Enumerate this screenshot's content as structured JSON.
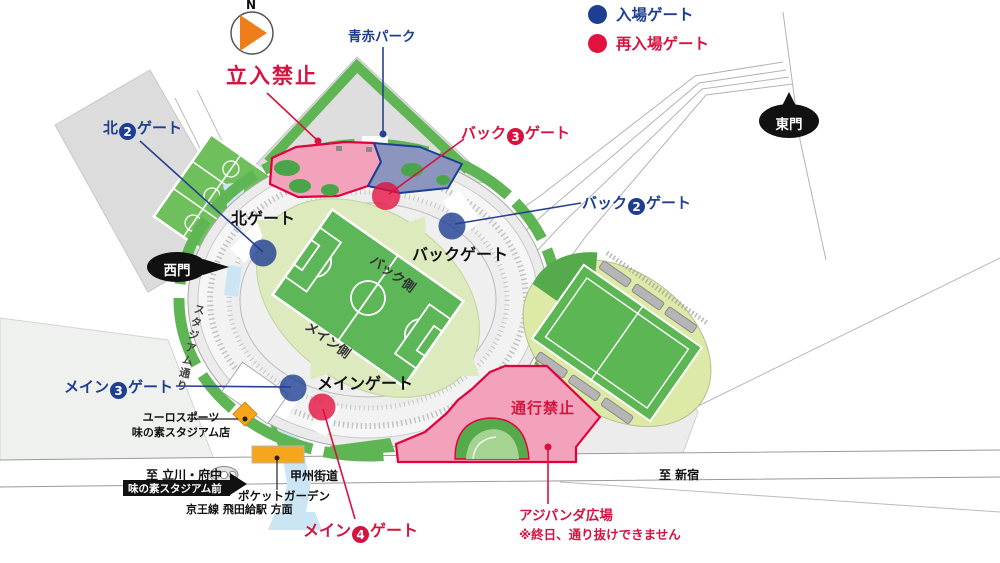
{
  "legend": {
    "items": [
      {
        "label": "入場ゲート",
        "color": "#1e3e92",
        "type": "entry"
      },
      {
        "label": "再入場ゲート",
        "color": "#e2123f",
        "type": "reentry"
      }
    ]
  },
  "compass": {
    "north_label": "N"
  },
  "zones": {
    "aoaka_park": {
      "label": "青赤パーク"
    },
    "no_entry": {
      "label": "立入禁止"
    },
    "no_passage": {
      "label": "通行禁止"
    },
    "ajipanda_plaza": {
      "label": "アジパンダ広場",
      "note": "※終日、通り抜けできません"
    }
  },
  "gates": {
    "north2": {
      "prefix": "北",
      "number": "2",
      "suffix": "ゲート",
      "type": "entry"
    },
    "back3": {
      "prefix": "バック",
      "number": "3",
      "suffix": "ゲート",
      "type": "reentry"
    },
    "back2": {
      "prefix": "バック",
      "number": "2",
      "suffix": "ゲート",
      "type": "entry"
    },
    "main3": {
      "prefix": "メイン",
      "number": "3",
      "suffix": "ゲート",
      "type": "entry"
    },
    "main4": {
      "prefix": "メイン",
      "number": "4",
      "suffix": "ゲート",
      "type": "reentry"
    },
    "north_gate": {
      "label": "北ゲート"
    },
    "back_gate": {
      "label": "バックゲート"
    },
    "main_gate": {
      "label": "メインゲート"
    },
    "east_mon": {
      "label": "東門"
    },
    "west_mon": {
      "label": "西門"
    }
  },
  "stadium": {
    "back_side_label": "バック側",
    "main_side_label": "メイン側"
  },
  "places": {
    "eurosports_line1": "ユーロスポーツ",
    "eurosports_line2": "味の素スタジアム店",
    "pocket_garden": "ポケットガーデン",
    "stadium_street": "スタジアム通り",
    "bus_stop": "味の素スタジアム前",
    "koshu_kaido": "甲州街道",
    "to_tachikawa_fuchu": "至 立川・府中",
    "to_shinjuku": "至 新宿",
    "keio_line": "京王線 飛田給駅 方面"
  },
  "colors": {
    "entry_blue": "#1e3e92",
    "reentry_red": "#e2123f",
    "restricted_pink": "#f2a3bb",
    "restricted_stroke": "#e2003c",
    "park_blue_fill": "#8b95bd",
    "map_green": "#5fb553",
    "pitch_green": "#5db657",
    "bowl_green": "#ddeabd",
    "walkway_blue": "#cbe5f4",
    "landmark_orange": "#f5a61d"
  }
}
